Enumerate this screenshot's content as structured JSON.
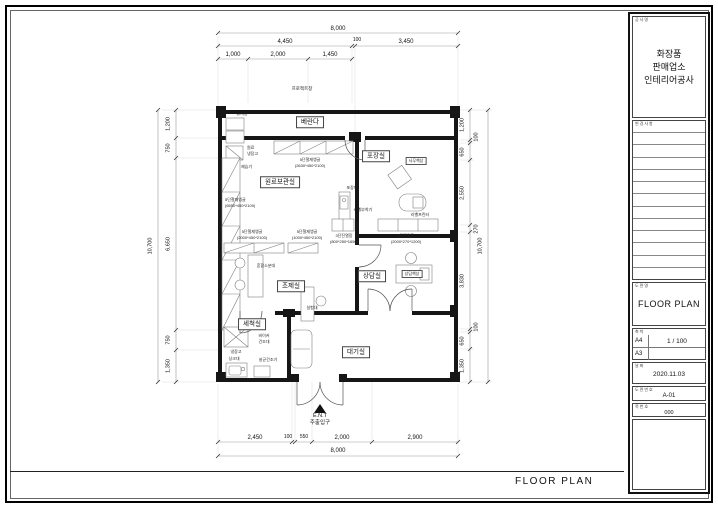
{
  "footer": {
    "title": "FLOOR PLAN"
  },
  "title_block": {
    "project": {
      "header": "공사명",
      "line1": "화장품",
      "line2": "판매업소",
      "line3": "인테리어공사"
    },
    "revisions": {
      "header": "변경사항"
    },
    "drawing": {
      "header": "도면명",
      "title": "FLOOR PLAN"
    },
    "scale": {
      "header": "축척",
      "paper1": "A4",
      "value1": "1 / 100",
      "paper2": "A3",
      "value2": ""
    },
    "date": {
      "header": "날짜",
      "value": "2020.11.03"
    },
    "number": {
      "header": "도면번호",
      "value": "A-01"
    },
    "sheet": {
      "header": "쪽번호",
      "value": "000"
    }
  },
  "dimensions": {
    "top": {
      "total": "8,000",
      "row2": [
        "4,450",
        "100",
        "3,450"
      ],
      "row3": [
        "1,000",
        "2,000",
        "1,450"
      ]
    },
    "bottom": {
      "segments": [
        "2,450",
        "100",
        "550",
        "2,000",
        "2,900"
      ],
      "total": "8,000"
    },
    "left": {
      "total": "10,700",
      "segments": [
        "1,200",
        "750",
        "6,650",
        "750",
        "1,350"
      ]
    },
    "right": {
      "total": "10,700",
      "segments": [
        "1,200",
        "100",
        "650",
        "2,550",
        "270",
        "3,830",
        "100",
        "650",
        "1,350"
      ]
    }
  },
  "plan": {
    "window_label": "프로젝트창",
    "entrance": {
      "line1": "E.N.T",
      "line2": "주출입구"
    },
    "rooms": {
      "veranda": "베란다",
      "storage": "원료보관실",
      "packing": "포장실",
      "prep": "조제실",
      "consult": "상담실",
      "wash": "세척실",
      "wait": "대기실"
    },
    "fixtures": {
      "trash": "휴지통",
      "mat_fridge1": "원료",
      "mat_fridge2": "냉장고",
      "dehumidifier": "제습기",
      "shelf_a_name": "5단철재앵글",
      "shelf_a_size": "(2630*450*2100)",
      "shelf_b_name": "5단철재앵글",
      "shelf_b_size": "(6550*450*2100)",
      "shelf_c_name": "5단철재앵글",
      "shelf_c_size": "(2000*450*2100)",
      "shelf_d_name": "5단철재앵글",
      "shelf_d_size": "(1000*450*2100)",
      "mixing_table": "혼합소분대",
      "lab_table": "실험대",
      "fridge": "냉장고",
      "beaker1": "비이커",
      "beaker2": "건조대",
      "sink": "싱크대",
      "sterilizer": "살균건조기",
      "packing_table": "포장대",
      "labeler": "라벨부착기",
      "label_printer": "라벨프린터",
      "office_desk": "사무책상",
      "display_a_name": "3단진열장",
      "display_a_size": "(800*250*1650)",
      "display_b_name": "3단진열장",
      "display_b_size": "(2000*270*1200)",
      "consult_desk": "상담책상"
    }
  }
}
